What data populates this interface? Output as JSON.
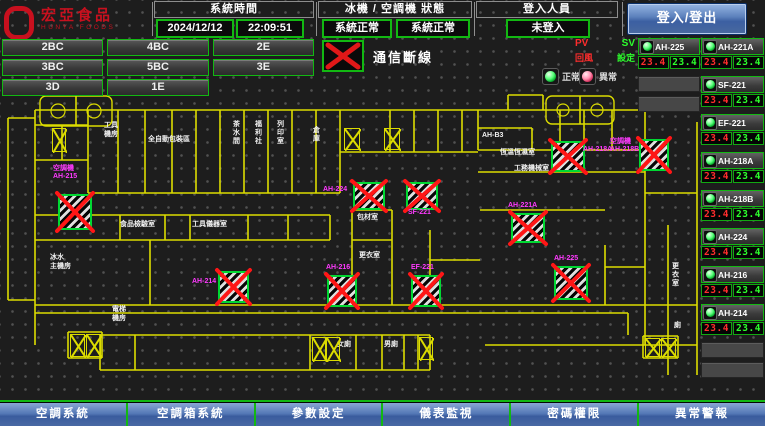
{
  "header": {
    "logo": {
      "line1": "宏亞食品",
      "line2": "HUNYA FOODS"
    },
    "system_time": {
      "label": "系統時間",
      "date": "2024/12/12",
      "time": "22:09:51"
    },
    "machine_status": {
      "label": "冰機 / 空調機 狀態",
      "chiller": "系統正常",
      "ahu": "系統正常"
    },
    "login": {
      "label": "登入人員",
      "value": "未登入",
      "button": "登入/登出"
    }
  },
  "floor_buttons": [
    "2BC",
    "4BC",
    "2E",
    "3BC",
    "5BC",
    "3E",
    "3D",
    "1E"
  ],
  "comm_legend": {
    "label": "通信斷線"
  },
  "status_legend": {
    "normal": "正常",
    "abnormal": "異常"
  },
  "pv_sv": {
    "pv": "PV",
    "sv": "SV",
    "pv_desc": "回風",
    "sv_desc": "設定"
  },
  "right_panel": {
    "column_a": {
      "units": [
        {
          "name": "AH-225",
          "pv": "23.4",
          "sv": "23.4",
          "status": "normal"
        }
      ],
      "empty_rows": 2
    },
    "column_b": {
      "units": [
        {
          "name": "AH-221A",
          "pv": "23.4",
          "sv": "23.4",
          "status": "normal"
        },
        {
          "name": "SF-221",
          "pv": "23.4",
          "sv": "23.4",
          "status": "normal"
        },
        {
          "name": "EF-221",
          "pv": "23.4",
          "sv": "23.4",
          "status": "normal"
        },
        {
          "name": "AH-218A",
          "pv": "23.4",
          "sv": "23.4",
          "status": "normal"
        },
        {
          "name": "AH-218B",
          "pv": "23.4",
          "sv": "23.4",
          "status": "normal"
        },
        {
          "name": "AH-224",
          "pv": "23.4",
          "sv": "23.4",
          "status": "normal"
        },
        {
          "name": "AH-216",
          "pv": "23.4",
          "sv": "23.4",
          "status": "normal"
        },
        {
          "name": "AH-214",
          "pv": "23.4",
          "sv": "23.4",
          "status": "normal"
        }
      ],
      "empty_rows": 2
    }
  },
  "map": {
    "rooms": [
      {
        "lines": [
          "工具",
          "機房"
        ],
        "x": 104,
        "y": 30
      },
      {
        "text": "全自動包裝區",
        "x": 148,
        "y": 44
      },
      {
        "text": "茶水間",
        "x": 231,
        "y": 28,
        "vertical": true
      },
      {
        "text": "福利社",
        "x": 253,
        "y": 28,
        "vertical": true
      },
      {
        "text": "列印室",
        "x": 275,
        "y": 28,
        "vertical": true
      },
      {
        "text": "倉庫",
        "x": 311,
        "y": 34,
        "vertical": true
      },
      {
        "text": "AH-B3",
        "x": 482,
        "y": 40
      },
      {
        "text": "恆溫恆濕室",
        "x": 500,
        "y": 57
      },
      {
        "text": "工務機械室",
        "x": 514,
        "y": 73
      },
      {
        "text": "包材室",
        "x": 357,
        "y": 122
      },
      {
        "text": "更衣室",
        "x": 359,
        "y": 160
      },
      {
        "text": "食品檢驗室",
        "x": 120,
        "y": 129
      },
      {
        "text": "工具儀器室",
        "x": 192,
        "y": 129
      },
      {
        "lines": [
          "冰水",
          "主機房"
        ],
        "x": 50,
        "y": 162
      },
      {
        "lines": [
          "電梯",
          "機房"
        ],
        "x": 112,
        "y": 214
      },
      {
        "text": "更衣室",
        "x": 670,
        "y": 170,
        "vertical": true
      },
      {
        "text": "廁",
        "x": 674,
        "y": 230
      },
      {
        "text": "女廁",
        "x": 337,
        "y": 249
      },
      {
        "text": "男廁",
        "x": 384,
        "y": 249
      }
    ],
    "equipment": [
      {
        "name": "AH-215",
        "x": 58,
        "y": 102,
        "w": 30,
        "h": 32,
        "label": {
          "lines": [
            "空調機",
            "AH-215"
          ],
          "x": 53,
          "y": 73
        }
      },
      {
        "name": "AH-214",
        "x": 218,
        "y": 179,
        "w": 27,
        "h": 28,
        "label": {
          "lines": [
            "AH-214"
          ],
          "x": 192,
          "y": 186
        }
      },
      {
        "name": "AH-224",
        "x": 353,
        "y": 90,
        "w": 28,
        "h": 24,
        "label": {
          "lines": [
            "AH-224"
          ],
          "x": 323,
          "y": 94
        }
      },
      {
        "name": "SF-221",
        "x": 406,
        "y": 90,
        "w": 28,
        "h": 24,
        "label": {
          "lines": [
            "SF-221"
          ],
          "x": 408,
          "y": 117
        }
      },
      {
        "name": "AH-221A",
        "x": 511,
        "y": 121,
        "w": 30,
        "h": 26,
        "label": {
          "lines": [
            "AH-221A"
          ],
          "x": 508,
          "y": 110
        }
      },
      {
        "name": "AH-216",
        "x": 327,
        "y": 183,
        "w": 26,
        "h": 28,
        "label": {
          "lines": [
            "AH-216"
          ],
          "x": 326,
          "y": 172
        }
      },
      {
        "name": "EF-221",
        "x": 411,
        "y": 183,
        "w": 26,
        "h": 28,
        "label": {
          "lines": [
            "EF-221"
          ],
          "x": 411,
          "y": 172
        }
      },
      {
        "name": "AH-225",
        "x": 554,
        "y": 174,
        "w": 30,
        "h": 30,
        "label": {
          "lines": [
            "AH-225"
          ],
          "x": 554,
          "y": 163
        }
      },
      {
        "name": "AH-218A",
        "x": 551,
        "y": 49,
        "w": 30,
        "h": 27,
        "label": {
          "lines": [
            "AH-218A"
          ],
          "x": 583,
          "y": 54
        }
      },
      {
        "name": "AH-218B",
        "x": 639,
        "y": 47,
        "w": 26,
        "h": 28,
        "label": {
          "lines": [
            "空調機",
            "AH-218B"
          ],
          "x": 610,
          "y": 46
        }
      }
    ],
    "stairs": [
      {
        "x": 52,
        "y": 36,
        "w": 14,
        "h": 24
      },
      {
        "x": 344,
        "y": 36,
        "w": 16,
        "h": 22
      },
      {
        "x": 384,
        "y": 36,
        "w": 16,
        "h": 22
      },
      {
        "x": 70,
        "y": 242,
        "w": 15,
        "h": 23
      },
      {
        "x": 86,
        "y": 242,
        "w": 15,
        "h": 23
      },
      {
        "x": 312,
        "y": 245,
        "w": 14,
        "h": 24
      },
      {
        "x": 326,
        "y": 245,
        "w": 14,
        "h": 24
      },
      {
        "x": 419,
        "y": 245,
        "w": 14,
        "h": 23
      },
      {
        "x": 645,
        "y": 246,
        "w": 15,
        "h": 19
      },
      {
        "x": 661,
        "y": 246,
        "w": 15,
        "h": 19
      }
    ]
  },
  "bottom_buttons": [
    "空調系統",
    "空調箱系統",
    "參數設定",
    "儀表監視",
    "密碼權限",
    "異常警報"
  ],
  "colors": {
    "accent-green": "#12b812",
    "alarm-red": "#e01818",
    "label-magenta": "#ff3aff",
    "plan-yellow": "#dcdc00",
    "button-blue": "#4a6aa4",
    "pv-red": "#ff2d2d",
    "sv-green": "#2dff2d",
    "logo-red": "#c8101e"
  }
}
